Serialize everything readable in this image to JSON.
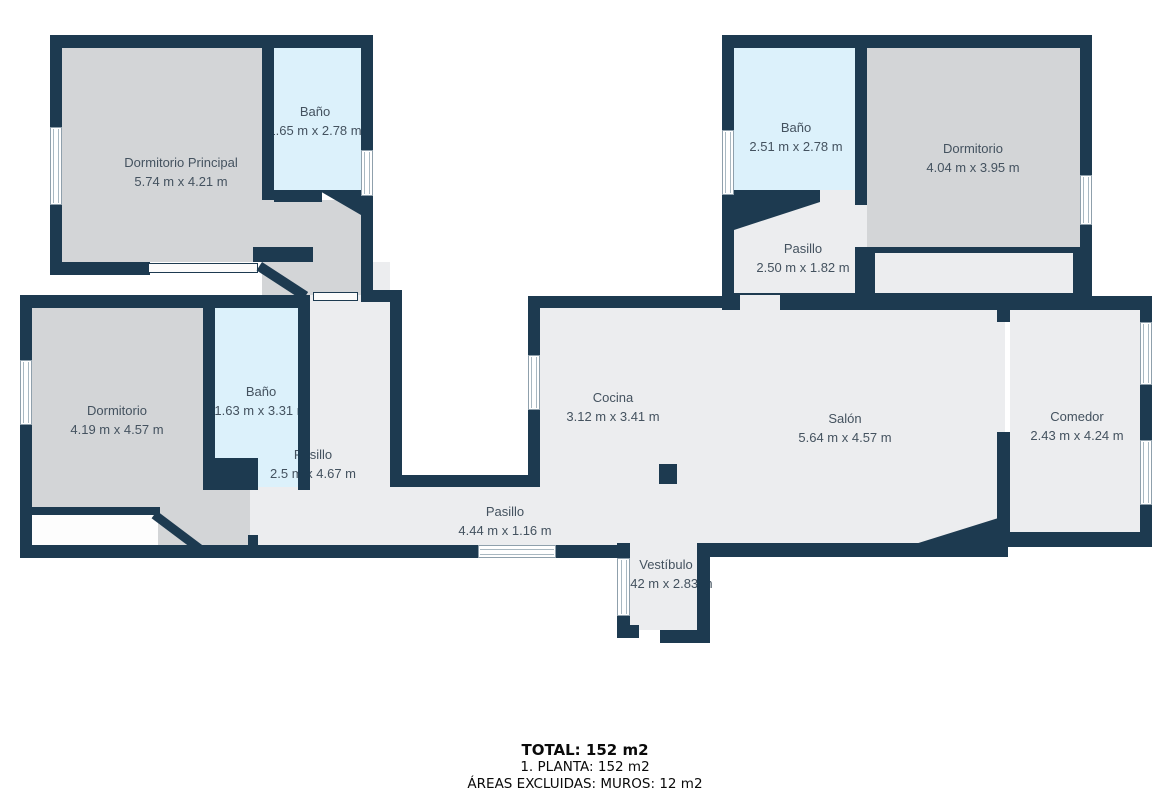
{
  "plan": {
    "type": "floor-plan",
    "floor_label": "1. PLANTA",
    "colors": {
      "wall": "#1d3a50",
      "bedroom_floor": "#d3d5d7",
      "generic_floor": "#ecedef",
      "bathroom_floor": "#dcf1fb",
      "label_text": "#44525f",
      "background": "#ffffff"
    }
  },
  "rooms": [
    {
      "id": "dormitorio-principal",
      "name": "Dormitorio Principal",
      "dims": "5.74 m x 4.21 m"
    },
    {
      "id": "bano-principal",
      "name": "Baño",
      "dims": "1.65 m x 2.78 m"
    },
    {
      "id": "bano-top-right",
      "name": "Baño",
      "dims": "2.51 m x 2.78 m"
    },
    {
      "id": "dormitorio-top-right",
      "name": "Dormitorio",
      "dims": "4.04 m x 3.95 m"
    },
    {
      "id": "pasillo-top-right",
      "name": "Pasillo",
      "dims": "2.50 m x 1.82 m"
    },
    {
      "id": "dormitorio-left",
      "name": "Dormitorio",
      "dims": "4.19 m x 4.57 m"
    },
    {
      "id": "bano-left",
      "name": "Baño",
      "dims": "1.63 m x 3.31 m"
    },
    {
      "id": "pasillo-vertical",
      "name": "Pasillo",
      "dims": "2.5 m x 4.67 m"
    },
    {
      "id": "cocina",
      "name": "Cocina",
      "dims": "3.12 m x 3.41 m"
    },
    {
      "id": "salon",
      "name": "Salón",
      "dims": "5.64 m x 4.57 m"
    },
    {
      "id": "comedor",
      "name": "Comedor",
      "dims": "2.43 m x 4.24 m"
    },
    {
      "id": "pasillo-horizontal",
      "name": "Pasillo",
      "dims": "4.44 m x 1.16 m"
    },
    {
      "id": "vestibulo",
      "name": "Vestíbulo",
      "dims": "1.42 m x 2.83 m"
    }
  ],
  "summary": {
    "total": "TOTAL: 152 m2",
    "planta": "1. PLANTA: 152 m2",
    "excluded": "ÁREAS EXCLUIDAS: MUROS: 12 m2"
  }
}
